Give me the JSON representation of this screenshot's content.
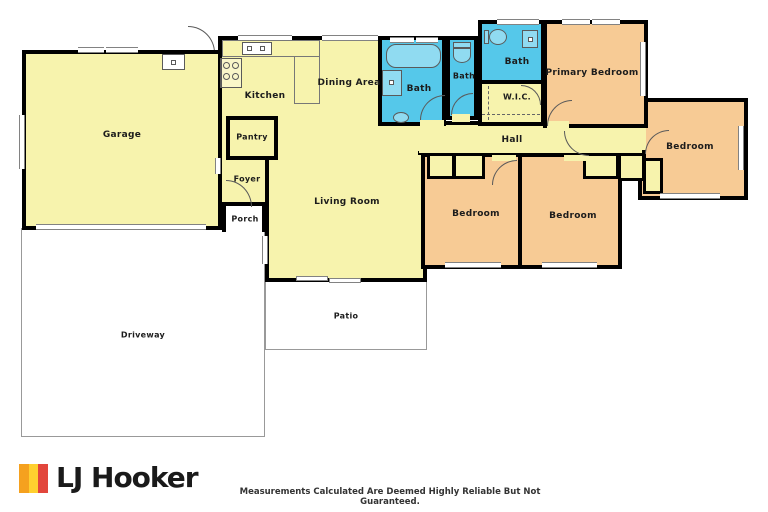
{
  "plan": {
    "rooms": {
      "garage": {
        "label": "Garage"
      },
      "kitchen": {
        "label": "Kitchen"
      },
      "dining": {
        "label": "Dining Area"
      },
      "living": {
        "label": "Living Room"
      },
      "pantry": {
        "label": "Pantry"
      },
      "foyer": {
        "label": "Foyer"
      },
      "porch": {
        "label": "Porch"
      },
      "bath_main": {
        "label": "Bath"
      },
      "bath_small": {
        "label": "Bath"
      },
      "bath_ensuite": {
        "label": "Bath"
      },
      "wic": {
        "label": "W.I.C."
      },
      "hall": {
        "label": "Hall"
      },
      "primary_bedroom": {
        "label": "Primary Bedroom"
      },
      "bedroom_east": {
        "label": "Bedroom"
      },
      "bedroom_south_left": {
        "label": "Bedroom"
      },
      "bedroom_south_right": {
        "label": "Bedroom"
      },
      "patio": {
        "label": "Patio"
      },
      "driveway": {
        "label": "Driveway"
      }
    },
    "colors": {
      "interior_floor": "#F7F3AD",
      "bedroom_floor": "#F7CB95",
      "bath_floor": "#55C8EA",
      "wall": "#000000",
      "outdoor_outline": "#999999"
    }
  },
  "footer": {
    "brand": "LJ Hooker",
    "disclaimer": "Measurements Calculated Are Deemed Highly Reliable But Not Guaranteed.",
    "logo_colors": {
      "left": "#F5A11F",
      "middle": "#FFD02F",
      "right": "#E2463C"
    }
  }
}
